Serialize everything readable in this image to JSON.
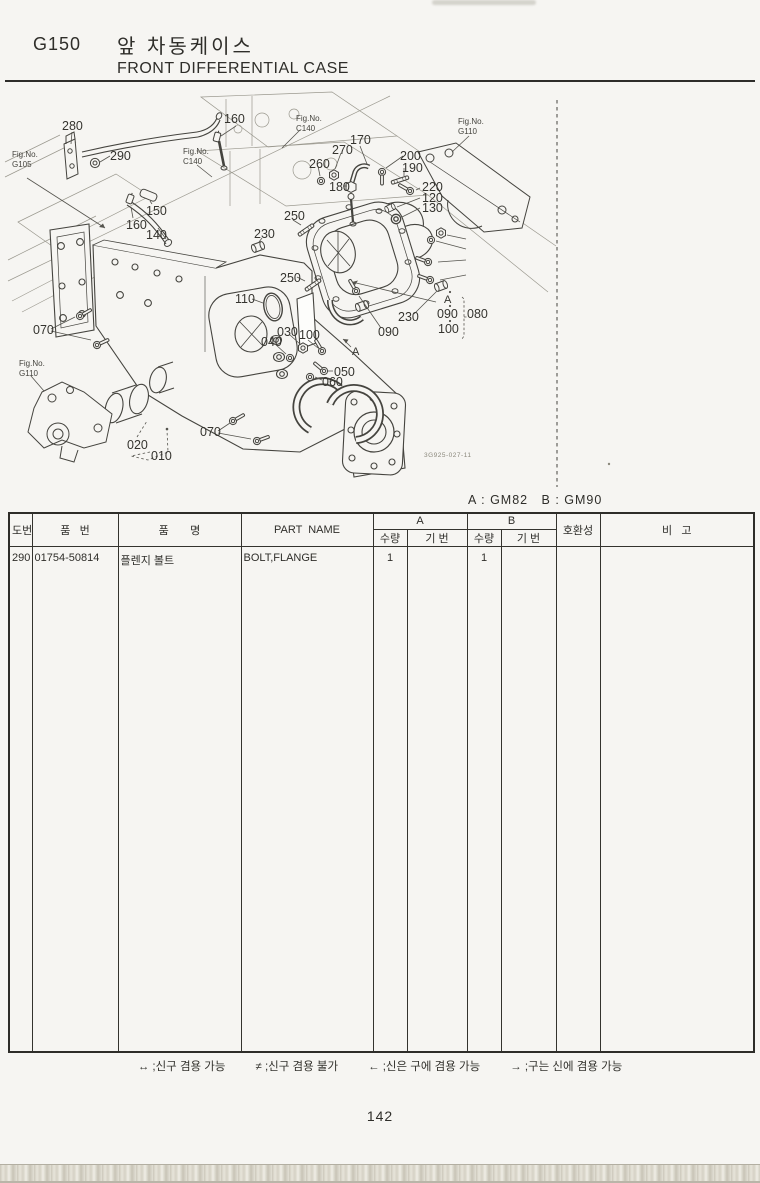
{
  "page": {
    "code": "G150",
    "title_ko": "앞 차동케이스",
    "title_en": "FRONT DIFFERENTIAL CASE",
    "model_note": "A : GM82   B : GM90",
    "drawing_no": "3G925-027-11",
    "page_number": "142"
  },
  "diagram": {
    "fig_refs": [
      {
        "line1": "Fig.No.",
        "line2": "G105",
        "x": 12,
        "y": 150
      },
      {
        "line1": "Fig.No.",
        "line2": "C140",
        "x": 183,
        "y": 147
      },
      {
        "line1": "Fig.No.",
        "line2": "C140",
        "x": 296,
        "y": 114
      },
      {
        "line1": "Fig.No.",
        "line2": "G110",
        "x": 458,
        "y": 117
      },
      {
        "line1": "Fig.No.",
        "line2": "G110",
        "x": 19,
        "y": 359
      }
    ],
    "callouts": [
      {
        "label": "280",
        "x": 62,
        "y": 120
      },
      {
        "label": "290",
        "x": 110,
        "y": 150
      },
      {
        "label": "160",
        "x": 224,
        "y": 113
      },
      {
        "label": "150",
        "x": 146,
        "y": 205
      },
      {
        "label": "160",
        "x": 126,
        "y": 219
      },
      {
        "label": "140",
        "x": 146,
        "y": 229
      },
      {
        "label": "170",
        "x": 350,
        "y": 134
      },
      {
        "label": "270",
        "x": 332,
        "y": 144
      },
      {
        "label": "260",
        "x": 309,
        "y": 158
      },
      {
        "label": "180",
        "x": 329,
        "y": 181
      },
      {
        "label": "200",
        "x": 400,
        "y": 150
      },
      {
        "label": "190",
        "x": 402,
        "y": 162
      },
      {
        "label": "220",
        "x": 422,
        "y": 181
      },
      {
        "label": "120",
        "x": 422,
        "y": 192
      },
      {
        "label": "130",
        "x": 422,
        "y": 202
      },
      {
        "label": "250",
        "x": 284,
        "y": 210
      },
      {
        "label": "230",
        "x": 254,
        "y": 228
      },
      {
        "label": "250",
        "x": 280,
        "y": 272
      },
      {
        "label": "110",
        "x": 235,
        "y": 293
      },
      {
        "label": "030",
        "x": 277,
        "y": 326
      },
      {
        "label": "040",
        "x": 261,
        "y": 336
      },
      {
        "label": "100",
        "x": 299,
        "y": 329
      },
      {
        "label": "050",
        "x": 334,
        "y": 366
      },
      {
        "label": "060",
        "x": 322,
        "y": 376
      },
      {
        "label": "070",
        "x": 33,
        "y": 324
      },
      {
        "label": "070",
        "x": 200,
        "y": 426
      },
      {
        "label": "020",
        "x": 127,
        "y": 439
      },
      {
        "label": "010",
        "x": 151,
        "y": 450
      },
      {
        "label": "090",
        "x": 378,
        "y": 326
      },
      {
        "label": "230",
        "x": 398,
        "y": 311
      },
      {
        "label": "A",
        "x": 352,
        "y": 347,
        "small": true
      },
      {
        "label": "A",
        "x": 444,
        "y": 295,
        "small": true
      },
      {
        "label": "090",
        "x": 437,
        "y": 308
      },
      {
        "label": "100",
        "x": 438,
        "y": 323
      },
      {
        "label": "080",
        "x": 467,
        "y": 308
      }
    ]
  },
  "table": {
    "headers": {
      "no": "도번",
      "part_no": "품   번",
      "name_ko": "품       명",
      "part_name": "PART  NAME",
      "group_a": "A",
      "group_b": "B",
      "qty_a": "수량",
      "serial_a": "기 번",
      "qty_b": "수량",
      "serial_b": "기 번",
      "compat": "호환성",
      "remarks": "비   고"
    },
    "rows": [
      {
        "no": "290",
        "part_no": "01754-50814",
        "name_ko": "플렌지 볼트",
        "part_name": "BOLT,FLANGE",
        "a_qty": "1",
        "a_serial": "",
        "b_qty": "1",
        "b_serial": "",
        "compat": "",
        "remarks": ""
      }
    ]
  },
  "legend": [
    {
      "symbol": "↔",
      "text": " ;신구 겸용 가능"
    },
    {
      "symbol": "≠",
      "text": " ;신구 겸용 불가"
    },
    {
      "symbol": "←",
      "text": " ;신은 구에 겸용 가능"
    },
    {
      "symbol": "→",
      "text": " ;구는 신에 겸용 가능"
    }
  ]
}
